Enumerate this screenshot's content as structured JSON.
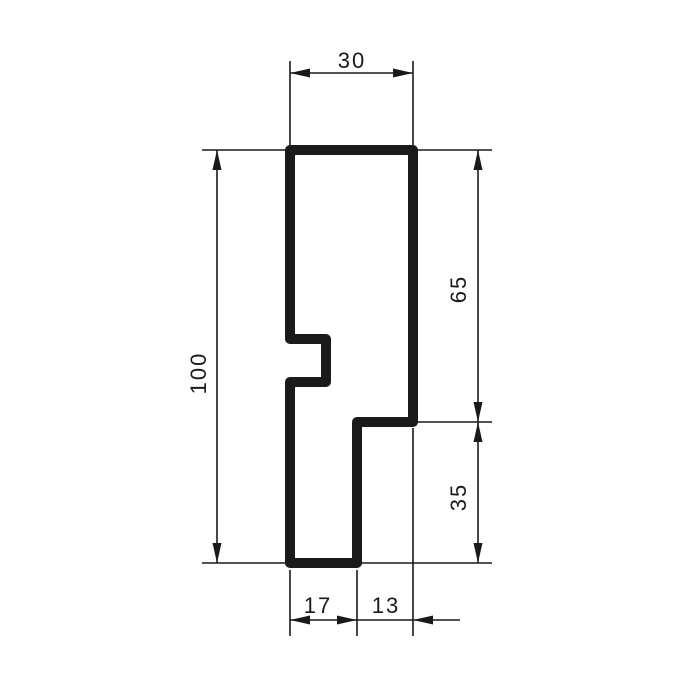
{
  "drawing": {
    "kind": "technical-profile-cross-section",
    "dimensions": {
      "top_width": "30",
      "overall_height": "100",
      "right_upper_height": "65",
      "right_lower_height": "35",
      "bottom_left_width": "17",
      "bottom_right_width": "13"
    }
  },
  "colors": {
    "line": "#1a1a1a",
    "background": "#ffffff"
  }
}
